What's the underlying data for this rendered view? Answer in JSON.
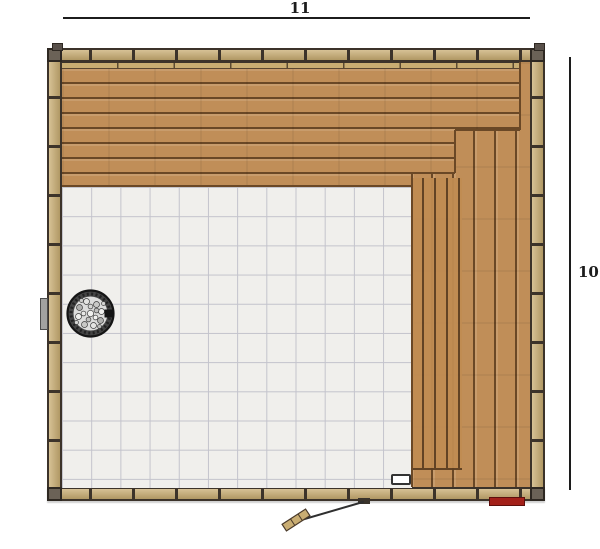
{
  "dimensions": {
    "top_label": "11",
    "right_label": "10"
  },
  "colors": {
    "dimension_line": "#1c1c1c",
    "wall_outline": "#3c332a",
    "stud_fill": "#c9ad72",
    "wood_plank": "#c08e58",
    "wood_seam": "#6a4826",
    "tile_fill": "#f0efec",
    "tile_line": "#c3c3cc",
    "heater_ring": "#454545",
    "heater_stone": "#dddddc",
    "accent_red": "#a32019"
  }
}
